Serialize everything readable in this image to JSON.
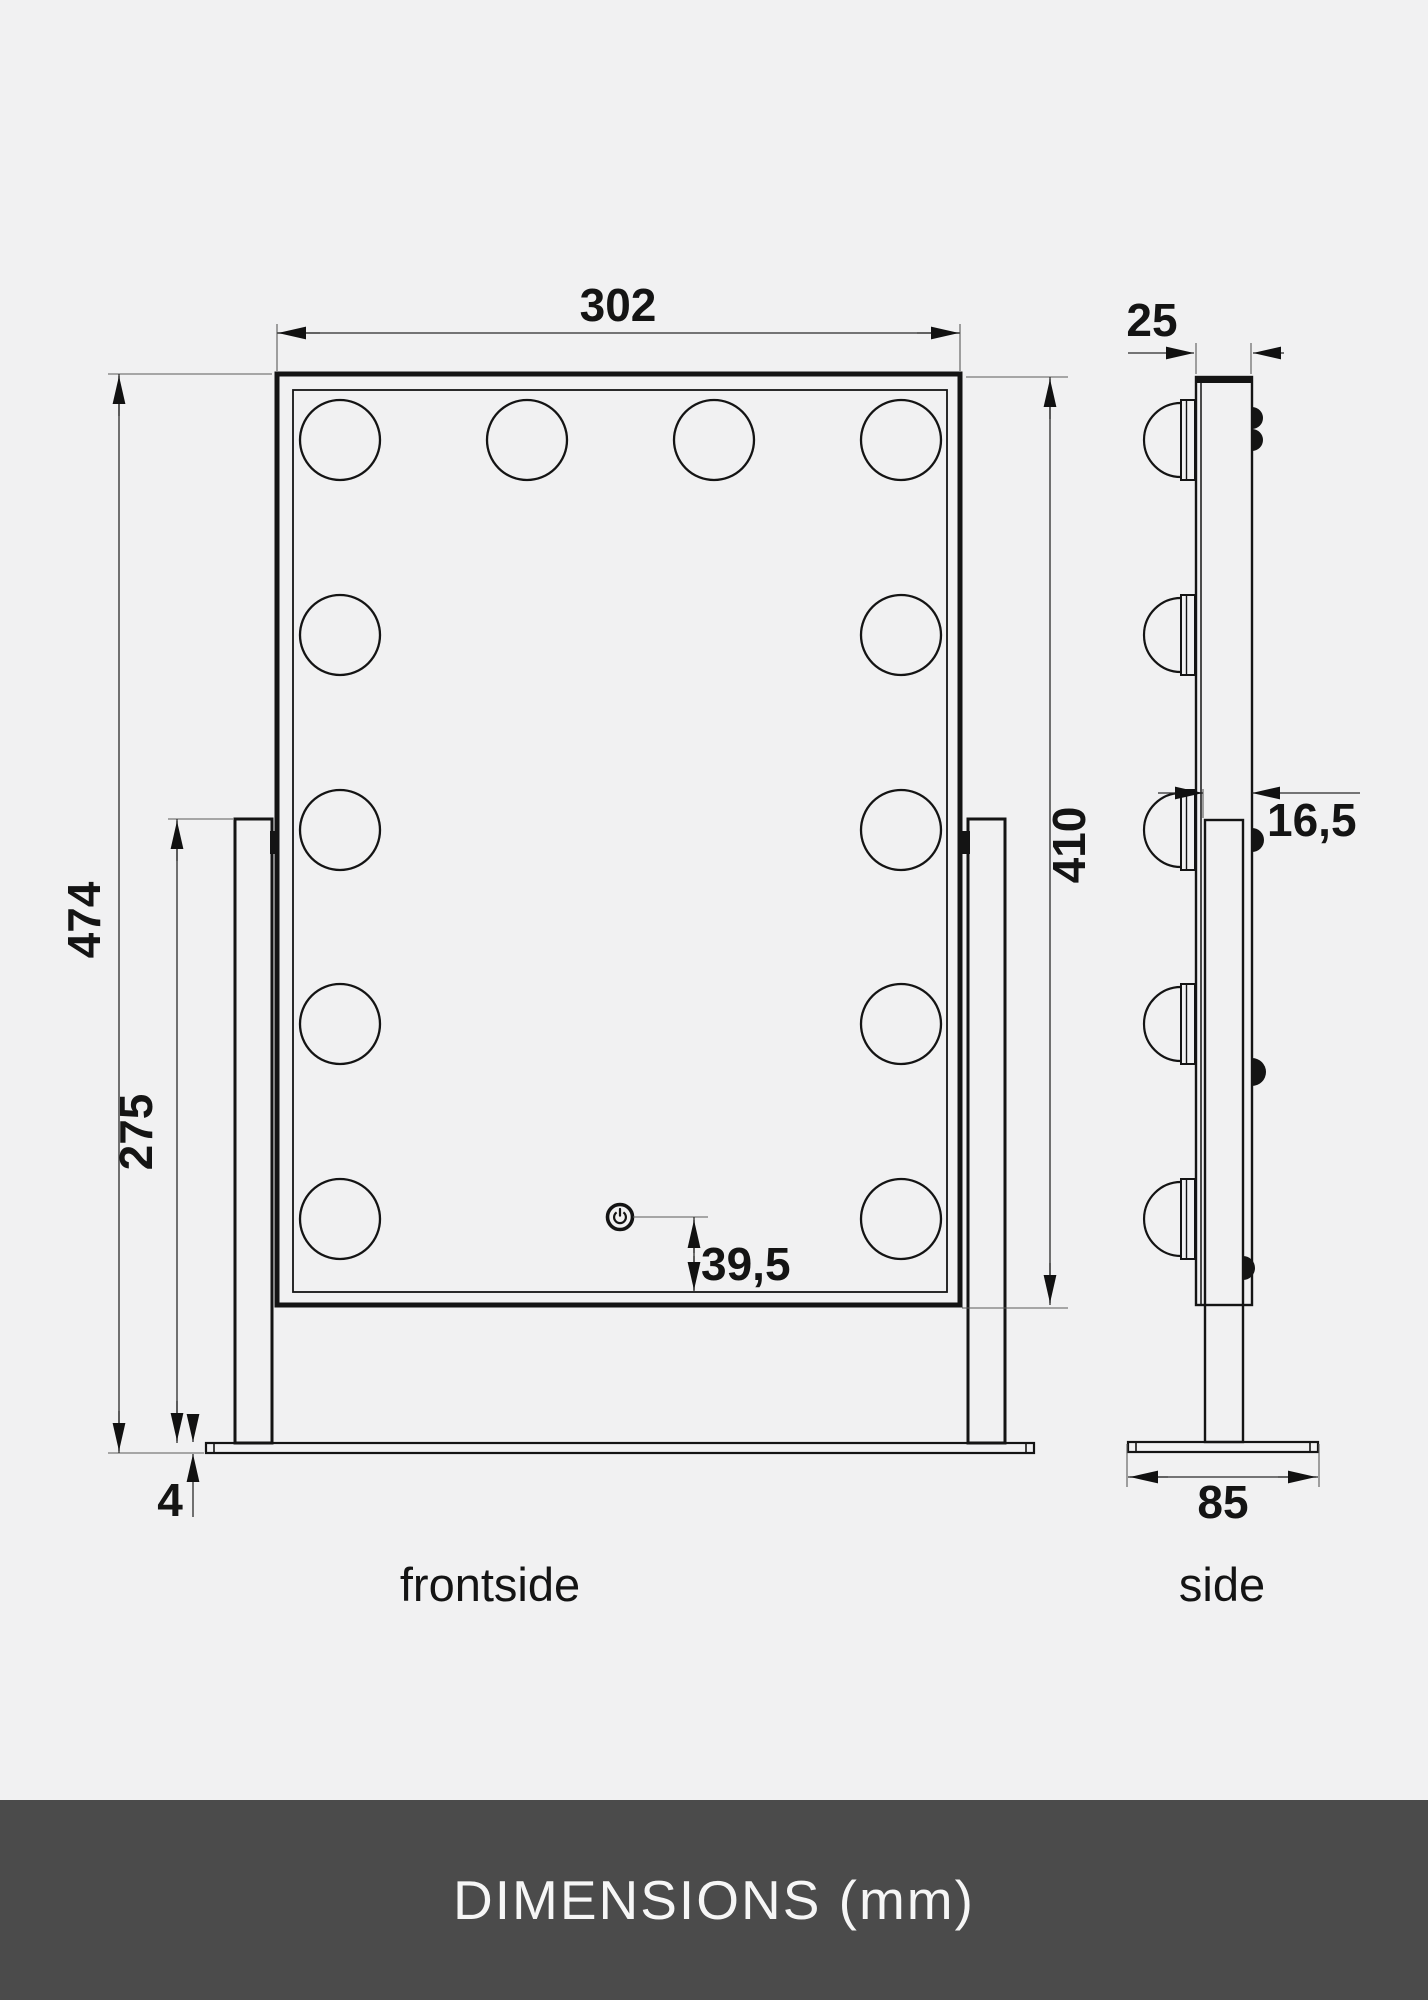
{
  "banner": {
    "title": "DIMENSIONS (mm)"
  },
  "views": {
    "front": {
      "label": "frontside",
      "dims": {
        "width": "302",
        "overall_height": "474",
        "stand_height": "275",
        "base_thickness": "4",
        "button_to_bottom": "39,5",
        "mirror_height": "410"
      }
    },
    "side": {
      "label": "side",
      "dims": {
        "mirror_depth": "25",
        "post_depth": "16,5",
        "base_depth": "85"
      }
    }
  },
  "drawing_info": {
    "front_bulb_count": 12,
    "side_bulb_count": 5,
    "units": "mm"
  },
  "colors": {
    "background": "#f1f1f2",
    "line": "#141414",
    "banner_background": "#4b4b4b",
    "banner_text": "#f6f6f6"
  }
}
